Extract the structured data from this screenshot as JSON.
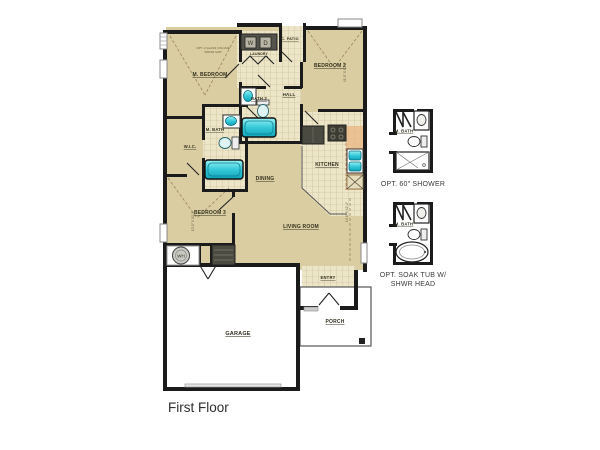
{
  "title": "First Floor",
  "rooms": {
    "m_bedroom": "M. BEDROOM",
    "bedroom_2": "BEDROOM 2",
    "bedroom_3": "BEDROOM 3",
    "m_bath": "M. BATH",
    "bath_2": "BATH 2",
    "wic": "W.I.C.",
    "hall": "HALL",
    "dining": "DINING",
    "kitchen": "KITCHEN",
    "living_room": "LIVING ROOM",
    "garage": "GARAGE",
    "porch": "PORCH",
    "entry": "ENTRY",
    "c_patio": "C. PATIO",
    "laundry": "LAUNDRY"
  },
  "appliances": {
    "washer": "W",
    "dryer": "D",
    "water_heater": "WH"
  },
  "annotations": {
    "m_bedroom_opt_line1": "OPT. 2 GLASS VOLUME",
    "m_bedroom_opt_line2": "WNDW GRP",
    "bedroom_2_dim": "11'-0\" X 10'-6\"",
    "bedroom_3_dim": "10'-0\" X 10'-2\"",
    "living_room_dim": "14'-6\" X 12'-4\""
  },
  "options": {
    "option_shower": {
      "room": "M. BATH",
      "caption": "OPT. 60\" SHOWER"
    },
    "option_soak_tub": {
      "room": "M. BATH",
      "caption_line1": "OPT. SOAK TUB W/",
      "caption_line2": "SHWR HEAD"
    }
  },
  "colors": {
    "floor": "#d9cda1",
    "tile": "#ece5c7",
    "tile_line": "#b5a97d",
    "wall": "#1b1b1b",
    "fixture": "#3fd2de",
    "appliance": "#4b4a40",
    "accent_salmon": "#e9b683",
    "text": "#33301f"
  }
}
